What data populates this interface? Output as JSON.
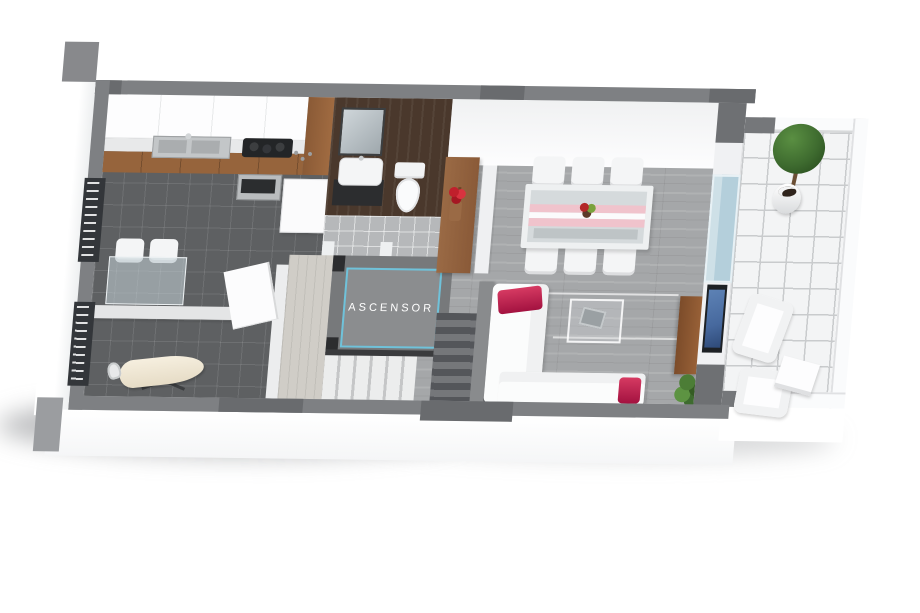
{
  "elevator": {
    "label": "ASCENSOR"
  },
  "colors": {
    "wall_gray": "#7e8083",
    "wall_dark": "#696b6e",
    "kitchen_tile": "#5e6062",
    "wood_floor": "#a5a7a9",
    "terrace_tile": "#f3f4f5",
    "bathroom_wall": "#4a382c",
    "cabinet_wood": "#96643c",
    "sideboard_wood": "#9a6a45",
    "accent_red": "#c62a52",
    "elevator_cyan": "#6fc2da",
    "elevator_fill": "#8b8d8f",
    "tv_blue": "#47699e",
    "glass_blue": "#b4cfdb",
    "plant_green": "#3e6b2f"
  }
}
